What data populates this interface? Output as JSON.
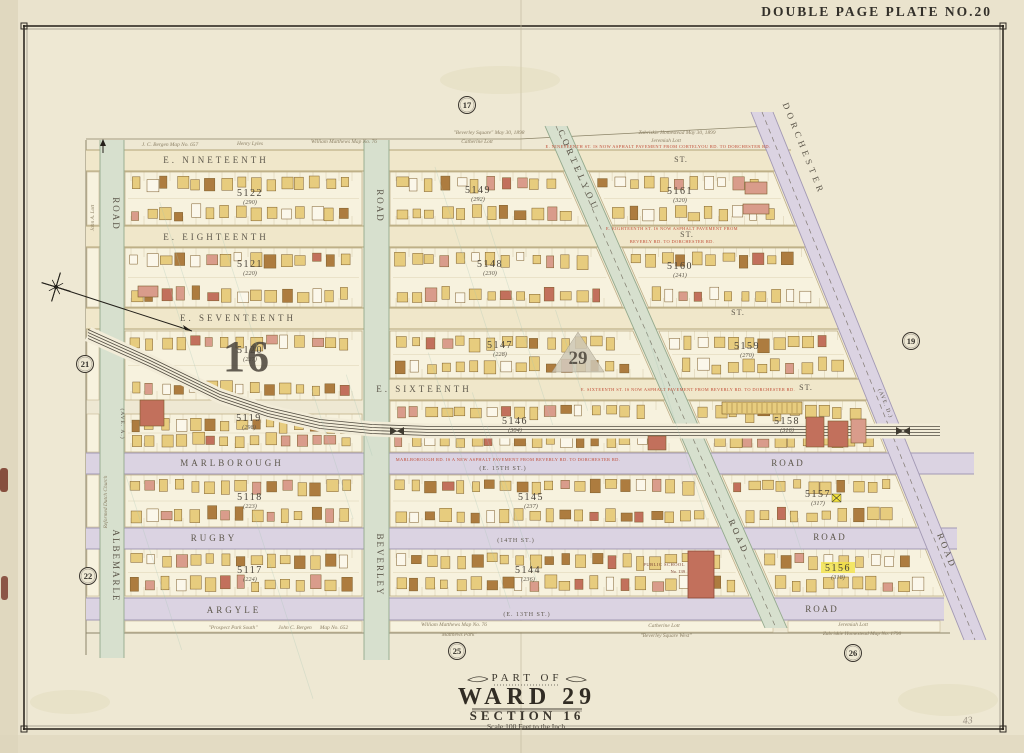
{
  "page": {
    "plate_title": "DOUBLE PAGE PLATE NO.20",
    "handwritten_note": "43",
    "colors": {
      "paper": "#eae3cd",
      "paper_edge": "#ddd5bc",
      "border": "#2f2a22",
      "block_fill": "#f7f2de",
      "block_line": "#bdac83",
      "street_cream": "#f0e7ca",
      "street_cream_line": "#b3a478",
      "road_lavender": "#dbd3e2",
      "road_lavender_line": "#a299b4",
      "road_green": "#d7e0ce",
      "road_green_line": "#93a98d",
      "rail": "#3f3a30",
      "red_note": "#bf4a34",
      "label": "#5d574b",
      "annotation": "#8b7f64",
      "building_yellow": "#e7cc7e",
      "building_brown": "#ad7c3f",
      "building_pink": "#d99c8b",
      "building_red": "#c2705c",
      "building_white": "#fbf7ea",
      "building_stroke": "#7c5d2b",
      "teal_streak": "#a4c4b4",
      "hinge": "#7d4030",
      "highlight": "#f2e23d"
    }
  },
  "title_block": {
    "part_of": "PART OF",
    "ward": "WARD 29",
    "section": "SECTION 16",
    "scale": "Scale 100 Feet to the Inch."
  },
  "map": {
    "section_label": "16",
    "ward_label": "29",
    "plate_refs": [
      {
        "n": "17",
        "x": 467,
        "y": 105
      },
      {
        "n": "19",
        "x": 911,
        "y": 341
      },
      {
        "n": "21",
        "x": 85,
        "y": 364
      },
      {
        "n": "22",
        "x": 88,
        "y": 576
      },
      {
        "n": "25",
        "x": 457,
        "y": 651
      },
      {
        "n": "26",
        "x": 853,
        "y": 653
      }
    ],
    "streets_horizontal": [
      {
        "name": "E. NINETEENTH ST.",
        "x1": 86,
        "x2": 791,
        "y": 150,
        "h": 21,
        "kind": "cream",
        "labels": [
          {
            "t": "E. NINETEENTH",
            "x": 216,
            "y": 163,
            "s": 9,
            "ls": 3
          },
          {
            "t": "ST.",
            "x": 681,
            "y": 162,
            "s": 8,
            "ls": 1
          }
        ]
      },
      {
        "name": "E. EIGHTEENTH ST.",
        "x1": 86,
        "x2": 813,
        "y": 226,
        "h": 21,
        "kind": "cream",
        "labels": [
          {
            "t": "E. EIGHTEENTH",
            "x": 216,
            "y": 240,
            "s": 9,
            "ls": 3
          },
          {
            "t": "ST.",
            "x": 687,
            "y": 237,
            "s": 8,
            "ls": 1
          }
        ]
      },
      {
        "name": "E. SEVENTEENTH ST.",
        "x1": 86,
        "x2": 852,
        "y": 308,
        "h": 21,
        "kind": "cream",
        "labels": [
          {
            "t": "E. SEVENTEENTH",
            "x": 238,
            "y": 321,
            "s": 9,
            "ls": 3
          },
          {
            "t": "ST.",
            "x": 738,
            "y": 315,
            "s": 8,
            "ls": 1
          }
        ]
      },
      {
        "name": "E. SIXTEENTH ST.",
        "x1": 364,
        "x2": 880,
        "y": 379,
        "h": 21,
        "kind": "cream",
        "labels": [
          {
            "t": "E. SIXTEENTH",
            "x": 424,
            "y": 392,
            "s": 9,
            "ls": 3
          },
          {
            "t": "ST.",
            "x": 806,
            "y": 390,
            "s": 8,
            "ls": 1
          }
        ]
      },
      {
        "name": "MARLBOROUGH ROAD (E. 15TH ST.)",
        "x1": 86,
        "x2": 974,
        "y": 453,
        "h": 21,
        "kind": "lavender",
        "labels": [
          {
            "t": "MARLBOROUGH",
            "x": 232,
            "y": 466,
            "s": 9,
            "ls": 3
          },
          {
            "t": "(E. 15TH ST.)",
            "x": 503,
            "y": 470,
            "s": 6,
            "ls": 1
          },
          {
            "t": "ROAD",
            "x": 788,
            "y": 466,
            "s": 9,
            "ls": 2
          }
        ]
      },
      {
        "name": "RUGBY ROAD (14TH ST.)",
        "x1": 86,
        "x2": 957,
        "y": 528,
        "h": 21,
        "kind": "lavender",
        "labels": [
          {
            "t": "RUGBY",
            "x": 214,
            "y": 541,
            "s": 9,
            "ls": 3
          },
          {
            "t": "(14TH ST.)",
            "x": 516,
            "y": 542,
            "s": 6,
            "ls": 1
          },
          {
            "t": "ROAD",
            "x": 830,
            "y": 540,
            "s": 9,
            "ls": 2
          }
        ]
      },
      {
        "name": "ARGYLE ROAD (E. 13TH ST.)",
        "x1": 86,
        "x2": 944,
        "y": 598,
        "h": 22,
        "kind": "lavender",
        "labels": [
          {
            "t": "ARGYLE",
            "x": 234,
            "y": 613,
            "s": 9,
            "ls": 3
          },
          {
            "t": "(E. 13TH ST.)",
            "x": 527,
            "y": 616,
            "s": 6,
            "ls": 1
          },
          {
            "t": "ROAD",
            "x": 822,
            "y": 612,
            "s": 9,
            "ls": 2
          }
        ]
      }
    ],
    "streets_vertical": [
      {
        "name": "ALBEMARLE ROAD (AVE. A.)",
        "x": 100,
        "w": 24,
        "y1": 140,
        "y2": 658,
        "kind": "green",
        "labels": [
          {
            "t": "ROAD",
            "x": 113,
            "y": 214,
            "s": 9,
            "ls": 2,
            "rot": 90
          },
          {
            "t": "(AVE. A.)",
            "x": 121,
            "y": 424,
            "s": 5.5,
            "ls": 1,
            "rot": 90
          },
          {
            "t": "ALBEMARLE",
            "x": 113,
            "y": 566,
            "s": 9,
            "ls": 2,
            "rot": 90
          }
        ]
      },
      {
        "name": "BEVERLEY ROAD",
        "x": 364,
        "w": 25,
        "y1": 140,
        "y2": 660,
        "kind": "green",
        "labels": [
          {
            "t": "ROAD",
            "x": 377,
            "y": 206,
            "s": 9,
            "ls": 2,
            "rot": 90
          },
          {
            "t": "BEVERLEY",
            "x": 377,
            "y": 565,
            "s": 9,
            "ls": 2,
            "rot": 90
          }
        ]
      }
    ],
    "streets_diagonal": [
      {
        "name": "CORTELYOU ROAD",
        "p1": [
          556,
          126
        ],
        "p2": [
          776,
          628
        ],
        "w": 22,
        "kind": "green",
        "labels": [
          {
            "t": "CORTELYOU",
            "x": 576,
            "y": 172,
            "s": 9,
            "ls": 4,
            "rot": 66
          },
          {
            "t": "ROAD",
            "x": 736,
            "y": 538,
            "s": 9,
            "ls": 3,
            "rot": 66
          }
        ]
      },
      {
        "name": "DORCHESTER ROAD (AVE. D.)",
        "p1": [
          762,
          112
        ],
        "p2": [
          975,
          640
        ],
        "w": 22,
        "kind": "lavender",
        "labels": [
          {
            "t": "DORCHESTER",
            "x": 801,
            "y": 150,
            "s": 9,
            "ls": 4,
            "rot": 68
          },
          {
            "t": "(AVE. D.)",
            "x": 884,
            "y": 404,
            "s": 5.5,
            "ls": 1,
            "rot": 68
          },
          {
            "t": "ROAD",
            "x": 944,
            "y": 552,
            "s": 9,
            "ls": 3,
            "rot": 68
          }
        ]
      }
    ],
    "blocks": [
      {
        "number": "5122",
        "old": "(290)",
        "row": [
          172,
          225
        ],
        "col": "A",
        "lx": 250,
        "ly": 196
      },
      {
        "number": "5149",
        "old": "(292)",
        "row": [
          172,
          225
        ],
        "col": "B",
        "lx": 478,
        "ly": 193
      },
      {
        "number": "5161",
        "old": "(320)",
        "row": [
          172,
          225
        ],
        "col": "C",
        "lx": 680,
        "ly": 194
      },
      {
        "number": "5121",
        "old": "(220)",
        "row": [
          248,
          307
        ],
        "col": "A",
        "lx": 250,
        "ly": 267
      },
      {
        "number": "5148",
        "old": "(230)",
        "row": [
          248,
          307
        ],
        "col": "B",
        "lx": 490,
        "ly": 267
      },
      {
        "number": "5160",
        "old": "(241)",
        "row": [
          248,
          307
        ],
        "col": "C",
        "lx": 680,
        "ly": 269
      },
      {
        "number": "5120",
        "old": "(227)",
        "row": [
          331,
          400
        ],
        "col": "A",
        "lx": 250,
        "ly": 353
      },
      {
        "number": "5147",
        "old": "(228)",
        "row": [
          331,
          378
        ],
        "col": "B",
        "lx": 500,
        "ly": 348
      },
      {
        "number": "5159",
        "old": "(270)",
        "row": [
          331,
          378
        ],
        "col": "C",
        "lx": 747,
        "ly": 349
      },
      {
        "number": "5119",
        "old": "(298)",
        "row": [
          414,
          452
        ],
        "col": "A",
        "lx": 249,
        "ly": 421
      },
      {
        "number": "5146",
        "old": "(304)",
        "row": [
          401,
          452
        ],
        "col": "B",
        "lx": 515,
        "ly": 424
      },
      {
        "number": "5158",
        "old": "(316)",
        "row": [
          401,
          452
        ],
        "col": "C",
        "lx": 787,
        "ly": 424
      },
      {
        "number": "5118",
        "old": "(223)",
        "row": [
          475,
          527
        ],
        "col": "A",
        "lx": 250,
        "ly": 500
      },
      {
        "number": "5145",
        "old": "(237)",
        "row": [
          475,
          527
        ],
        "col": "B",
        "lx": 531,
        "ly": 500
      },
      {
        "number": "5157",
        "old": "(317)",
        "row": [
          475,
          527
        ],
        "col": "C",
        "lx": 818,
        "ly": 497
      },
      {
        "number": "5117",
        "old": "(224)",
        "row": [
          549,
          596
        ],
        "col": "A",
        "lx": 250,
        "ly": 573
      },
      {
        "number": "5144",
        "old": "(236)",
        "row": [
          549,
          596
        ],
        "col": "B",
        "lx": 528,
        "ly": 573
      },
      {
        "number": "5156",
        "old": "(318)",
        "row": [
          549,
          596
        ],
        "col": "C",
        "lx": 838,
        "ly": 571,
        "highlight": true
      }
    ],
    "railroad": {
      "points": [
        [
          88,
          334
        ],
        [
          150,
          362
        ],
        [
          220,
          396
        ],
        [
          268,
          412
        ],
        [
          320,
          424
        ],
        [
          372,
          429
        ],
        [
          430,
          431
        ],
        [
          940,
          431
        ]
      ],
      "markers": [
        [
          397,
          431
        ],
        [
          903,
          431
        ]
      ]
    },
    "annotations": [
      {
        "t": "J. C. Bergen   Map No. 657",
        "x": 170,
        "y": 146
      },
      {
        "t": "Henry Lyles",
        "x": 250,
        "y": 145
      },
      {
        "t": "William Matthews   Map No. 76",
        "x": 344,
        "y": 143
      },
      {
        "t": "\"Beverley Square\"  May 30, 1898",
        "x": 489,
        "y": 134
      },
      {
        "t": "Catherine Lott",
        "x": 477,
        "y": 143
      },
      {
        "t": "Zabriskie Homestead  May 30, 1899",
        "x": 677,
        "y": 134
      },
      {
        "t": "Jeremiah Lott",
        "x": 666,
        "y": 142
      },
      {
        "t": "\"Prospect Park South\"",
        "x": 233,
        "y": 629
      },
      {
        "t": "John C. Bergen",
        "x": 295,
        "y": 629
      },
      {
        "t": "Map No. 652",
        "x": 334,
        "y": 629
      },
      {
        "t": "William Matthews   Map No. 76",
        "x": 454,
        "y": 626
      },
      {
        "t": "\"Matthews Park\"",
        "x": 458,
        "y": 636
      },
      {
        "t": "Catherine Lott",
        "x": 664,
        "y": 627
      },
      {
        "t": "\"Beverley Square West\"",
        "x": 666,
        "y": 637
      },
      {
        "t": "Jeremiah Lott",
        "x": 853,
        "y": 626
      },
      {
        "t": "Zabriskie Homestead  Map No. 1790",
        "x": 862,
        "y": 635
      },
      {
        "t": "John A. Lott",
        "x": 94,
        "y": 218,
        "rot": -90
      },
      {
        "t": "Reformed Dutch Church",
        "x": 107,
        "y": 502,
        "rot": -90
      }
    ],
    "paving_notes": [
      {
        "t": "E. NINETEENTH ST. IS NOW ASPHALT PAVEMENT FROM CORTELYOU RD. TO DORCHESTER RD.",
        "x": 658,
        "y": 148
      },
      {
        "t": "E. EIGHTEENTH ST. IS NOW ASPHALT PAVEMENT FROM",
        "x": 672,
        "y": 230
      },
      {
        "t": "BEVERLY RD. TO DORCHESTER RD.",
        "x": 672,
        "y": 243
      },
      {
        "t": "E. SIXTEENTH ST. IS NOW ASPHALT PAVEMENT FROM BEVERLY RD. TO DORCHESTER RD.",
        "x": 688,
        "y": 391
      },
      {
        "t": "MARLBOROUGH RD. IS A NEW ASPHALT PAVEMENT FROM BEVERLY RD. TO DORCHESTER RD.",
        "x": 508,
        "y": 461
      }
    ],
    "landmarks": {
      "school": {
        "label1": "PUBLIC SCHOOL",
        "label2": "No. 139",
        "x": 688,
        "y": 551,
        "w": 26,
        "h": 47,
        "label_x": 685,
        "label_y": 566
      }
    },
    "special_buildings": [
      {
        "x": 722,
        "y": 402,
        "w": 80,
        "h": 12,
        "c": "building_yellow",
        "stripes": true
      },
      {
        "x": 806,
        "y": 417,
        "w": 18,
        "h": 30,
        "c": "building_red"
      },
      {
        "x": 828,
        "y": 421,
        "w": 20,
        "h": 26,
        "c": "building_red"
      },
      {
        "x": 851,
        "y": 419,
        "w": 15,
        "h": 24,
        "c": "building_pink"
      },
      {
        "x": 745,
        "y": 182,
        "w": 22,
        "h": 12,
        "c": "building_pink"
      },
      {
        "x": 743,
        "y": 204,
        "w": 26,
        "h": 10,
        "c": "building_pink"
      },
      {
        "x": 648,
        "y": 436,
        "w": 18,
        "h": 14,
        "c": "building_red"
      },
      {
        "x": 140,
        "y": 400,
        "w": 24,
        "h": 26,
        "c": "building_red"
      },
      {
        "x": 138,
        "y": 286,
        "w": 20,
        "h": 11,
        "c": "building_pink"
      }
    ],
    "markers": [
      {
        "x": 832,
        "y": 494,
        "w": 9,
        "h": 8,
        "type": "x-box"
      }
    ],
    "compass": {
      "x": 56,
      "y": 287,
      "arrow_to": [
        192,
        331
      ]
    },
    "ward_triangle": [
      [
        552,
        372
      ],
      [
        604,
        372
      ],
      [
        578,
        332
      ]
    ],
    "big16_pos": {
      "x": 247,
      "y": 371
    },
    "big29_pos": {
      "x": 578,
      "y": 364
    }
  }
}
